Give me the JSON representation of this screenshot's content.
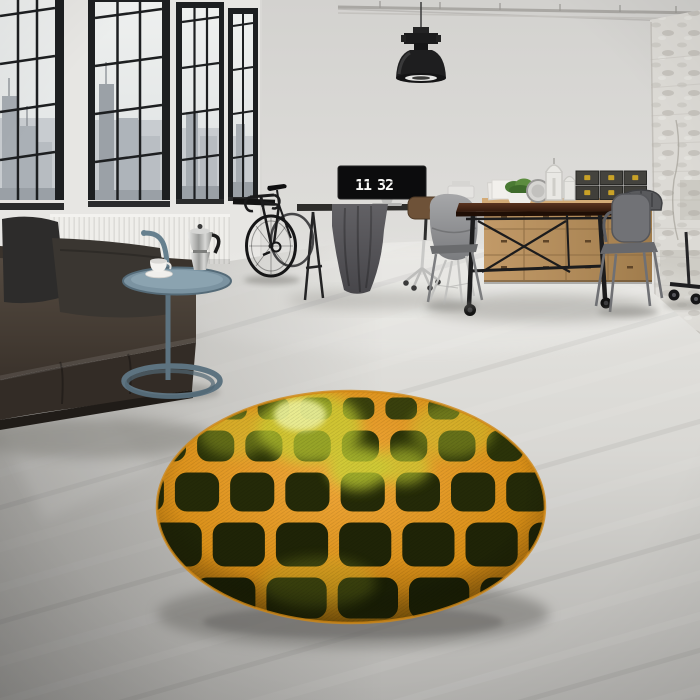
{
  "scene": {
    "type": "interior-photograph",
    "description": "Industrial loft room with black factory windows, leather sofa, bicycle, desk with flip-clock monitor, wooden sideboard and dining set, and a round orange-grid olive rug on a concrete floor",
    "width": 700,
    "height": 700
  },
  "clock": {
    "hours": "11",
    "minutes": "32"
  },
  "palette": {
    "wall": "#d8d7d4",
    "wall_light": "#e7e6e3",
    "ceiling": "#d2d1ce",
    "floor_back": "#e7e6e2",
    "floor_front": "#b0afac",
    "window_frame": "#1d1f21",
    "sky": "#eef0ef",
    "city_far": "#c8ccd0",
    "city_mid": "#a6acb2",
    "sofa_leather": "#4a4038",
    "sofa_dark": "#2f2a25",
    "pillow": "#2e2d2c",
    "radiator": "#efeeea",
    "table_steel": "#5d7380",
    "wood_sideboard": "#b78f5d",
    "wood_table": "#3d2317",
    "metal_chair": "#717276",
    "black_metal": "#1c1c1e",
    "box": "#403f3a",
    "box_latch": "#c9a227",
    "plant": "#4f7d36",
    "lamp": "#1e1e1f",
    "concrete_column": "#dcdad5"
  },
  "rug": {
    "center_x": 351,
    "center_y": 507,
    "radius_x": 194,
    "radius_y": 116,
    "grid": {
      "columns": 7,
      "rows": 5,
      "vanish_x": 345,
      "vanish_y": 128,
      "spacing_mid": 57.5,
      "col_center": 3.18,
      "row_lines": [
        392,
        425,
        467,
        517,
        572,
        624
      ],
      "gap": 11,
      "corner_radius": 12
    },
    "colors": {
      "line_light": "#f0a833",
      "line": "#d98f17",
      "line_dark": "#a86a09",
      "rows": [
        "#39400d",
        "#2b3309",
        "#242a08",
        "#1f2407",
        "#1b2006"
      ],
      "highlight": "#c6d435",
      "highlight_core": "#eef2a0"
    },
    "highlights": [
      {
        "x": 310,
        "y": 428,
        "rx": 52,
        "ry": 36,
        "o": 0.7
      },
      {
        "x": 300,
        "y": 415,
        "rx": 26,
        "ry": 16,
        "o": 0.85,
        "core": true
      },
      {
        "x": 358,
        "y": 468,
        "rx": 30,
        "ry": 22,
        "o": 0.75
      },
      {
        "x": 404,
        "y": 466,
        "rx": 26,
        "ry": 19,
        "o": 0.6
      },
      {
        "x": 452,
        "y": 430,
        "rx": 42,
        "ry": 28,
        "o": 0.38
      },
      {
        "x": 235,
        "y": 433,
        "rx": 36,
        "ry": 24,
        "o": 0.35
      },
      {
        "x": 318,
        "y": 583,
        "rx": 58,
        "ry": 26,
        "o": 0.2
      }
    ]
  },
  "objects": [
    {
      "name": "factory-windows",
      "count": 4
    },
    {
      "name": "radiator"
    },
    {
      "name": "leather-sofa"
    },
    {
      "name": "throw-pillows",
      "count": 2
    },
    {
      "name": "side-table"
    },
    {
      "name": "moka-pot"
    },
    {
      "name": "coffee-cup"
    },
    {
      "name": "bicycle"
    },
    {
      "name": "pendant-lamp"
    },
    {
      "name": "desk"
    },
    {
      "name": "monitor-flip-clock"
    },
    {
      "name": "desk-chairs",
      "count": 2
    },
    {
      "name": "wooden-sideboard"
    },
    {
      "name": "storage-boxes",
      "count": 6
    },
    {
      "name": "potted-plant"
    },
    {
      "name": "lanterns",
      "count": 2
    },
    {
      "name": "dining-table"
    },
    {
      "name": "metal-armchairs",
      "count": 3
    },
    {
      "name": "white-brick-column"
    },
    {
      "name": "round-rug"
    }
  ]
}
